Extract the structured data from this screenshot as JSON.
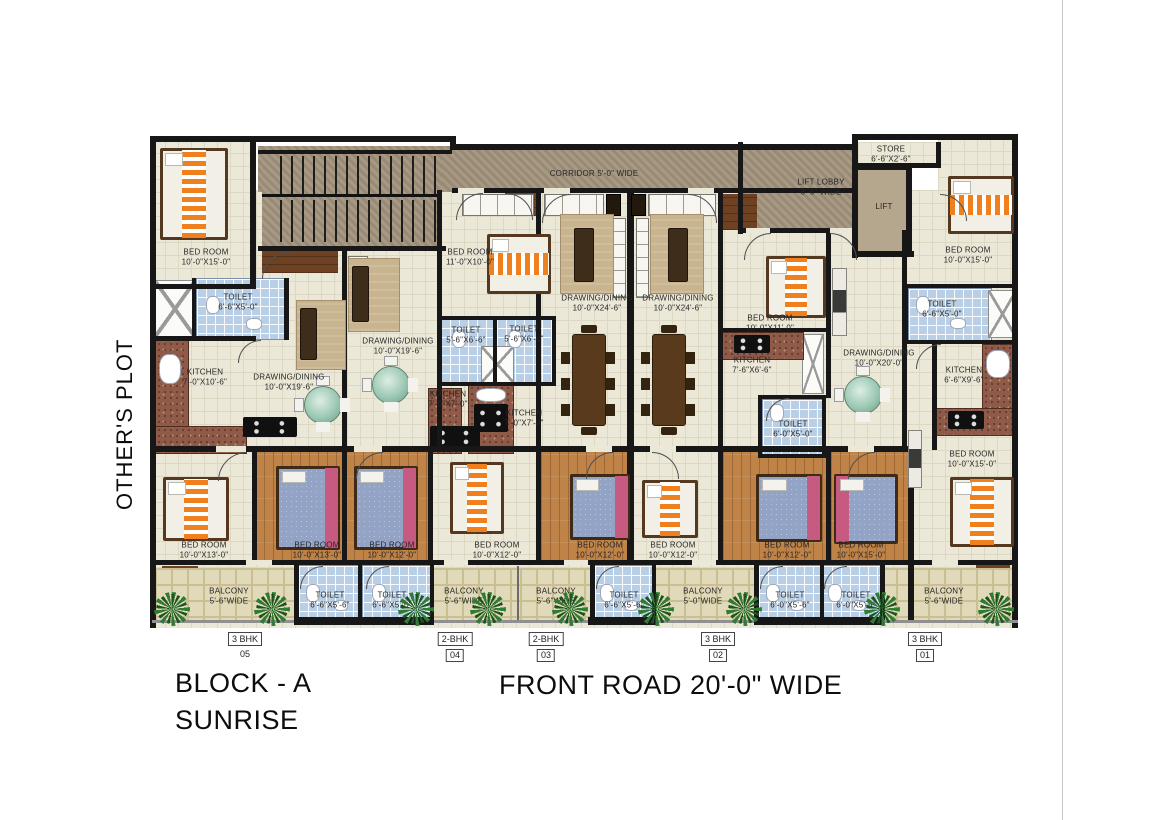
{
  "texts": {
    "others_plot": "OTHER'S PLOT",
    "block_line1": "BLOCK - A",
    "block_line2": "SUNRISE",
    "front_road": "FRONT ROAD 20'-0\" WIDE"
  },
  "units": [
    {
      "type": "3 BHK",
      "number": "05"
    },
    {
      "type": "2-BHK",
      "number": "04"
    },
    {
      "type": "2-BHK",
      "number": "03"
    },
    {
      "type": "3 BHK",
      "number": "02"
    },
    {
      "type": "3 BHK",
      "number": "01"
    }
  ],
  "rooms": [
    {
      "name": "BED ROOM",
      "dim": "10'-0\"X15'-0\""
    },
    {
      "name": "TOILET",
      "dim": "6'-6\"X5'-0\""
    },
    {
      "name": "KITCHEN",
      "dim": "7'-0\"X10'-6\""
    },
    {
      "name": "DRAWING/DINING",
      "dim": "10'-0\"X19'-6\""
    },
    {
      "name": "DRAWING/DINING",
      "dim": "10'-0\"X19'-6\""
    },
    {
      "name": "BED ROOM",
      "dim": "11'-0\"X10'-0\""
    },
    {
      "name": "TOILET",
      "dim": "5'-6\"X6'-6\""
    },
    {
      "name": "TOILET",
      "dim": "5'-6\"X6'-6\""
    },
    {
      "name": "KITCHEN",
      "dim": "7'-0\"X7'-0\""
    },
    {
      "name": "KITCHEN",
      "dim": "7'-0\"X7'-0\""
    },
    {
      "name": "DRAWING/DINING",
      "dim": "10'-0\"X24'-6\""
    },
    {
      "name": "DRAWING/DINING",
      "dim": "10'-0\"X24'-6\""
    },
    {
      "name": "KITCHEN",
      "dim": "7'-6\"X6'-6\""
    },
    {
      "name": "BED ROOM",
      "dim": "10'-0\"X11'-0\""
    },
    {
      "name": "TOILET",
      "dim": "6'-0\"X5'-0\""
    },
    {
      "name": "DRAWING/DINING",
      "dim": "10'-0\"X20'-0\""
    },
    {
      "name": "LIFT LOBBY",
      "dim": "8'-6\" WIDE"
    },
    {
      "name": "STORE",
      "dim": "6'-6\"X2'-6\""
    },
    {
      "name": "LIFT",
      "dim": ""
    },
    {
      "name": "CORRIDOR 5'-0\" WIDE",
      "dim": ""
    },
    {
      "name": "BED ROOM",
      "dim": "10'-0\"X15'-0\""
    },
    {
      "name": "TOILET",
      "dim": "6'-6\"X5'-0\""
    },
    {
      "name": "KITCHEN",
      "dim": "6'-6\"X9'-6\""
    },
    {
      "name": "BED ROOM",
      "dim": "10'-0\"X15'-0\""
    },
    {
      "name": "BED ROOM",
      "dim": "10'-0\"X13'-0\""
    },
    {
      "name": "BED ROOM",
      "dim": "10'-0\"X13'-0\""
    },
    {
      "name": "BED ROOM",
      "dim": "10'-0\"X12'-0\""
    },
    {
      "name": "BED ROOM",
      "dim": "10'-0\"X12'-0\""
    },
    {
      "name": "BED ROOM",
      "dim": "10'-0\"X12'-0\""
    },
    {
      "name": "BED ROOM",
      "dim": "10'-0\"X12'-0\""
    },
    {
      "name": "BED ROOM",
      "dim": "10'-0\"X12'-0\""
    },
    {
      "name": "BED ROOM",
      "dim": "10'-0\"X15'-0\""
    },
    {
      "name": "BALCONY",
      "dim": "5'-6\"WIDE"
    },
    {
      "name": "TOILET",
      "dim": "6'-6\"X5'-6\""
    },
    {
      "name": "TOILET",
      "dim": "6'-6\"X5'-6\""
    },
    {
      "name": "BALCONY",
      "dim": "5'-6\"WIDE"
    },
    {
      "name": "BALCONY",
      "dim": "5'-6\"WIDE"
    },
    {
      "name": "TOILET",
      "dim": "6'-6\"X5'-6\""
    },
    {
      "name": "BALCONY",
      "dim": "5'-0\"WIDE"
    },
    {
      "name": "TOILET",
      "dim": "6'-0\"X5'-6\""
    },
    {
      "name": "TOILET",
      "dim": "6'-0\"X5'-6\""
    },
    {
      "name": "BALCONY",
      "dim": "5'-6\"WIDE"
    }
  ],
  "colors": {
    "wall": "#171717",
    "floor": "#ece8d8",
    "corridor": "#a2937c",
    "wood": "#bf8348",
    "darkwood": "#6e4122",
    "tile": "#b9cfe6",
    "balcony": "#e0d9ba",
    "granite": "#8f5a48",
    "bed_orange": "#f07f1e",
    "bed_blue": "#93a3c6",
    "pink": "#c75a80",
    "plant": "#2e7d32"
  }
}
